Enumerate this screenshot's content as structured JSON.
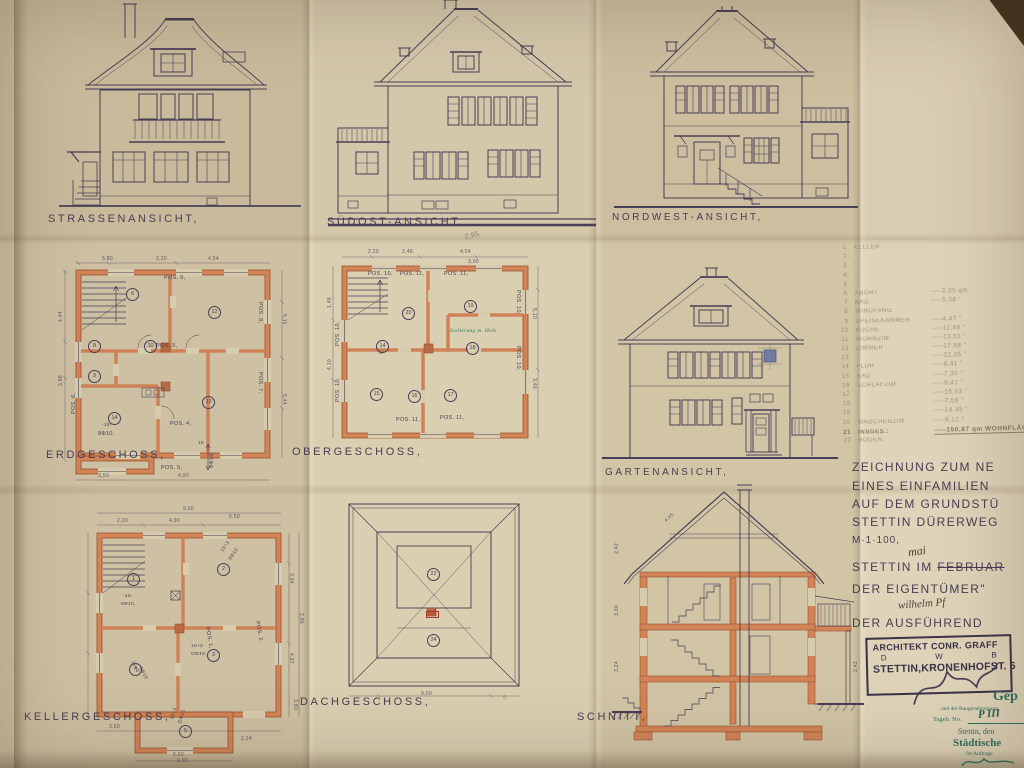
{
  "sheet": {
    "labels": {
      "strasse": "STRASSENANSICHT,",
      "suedost": "SÜDOST-ANSICHT,",
      "nordwest": "NORDWEST-ANSICHT,",
      "erdgeschoss": "ERDGESCHOSS,",
      "obergeschoss": "OBERGESCHOSS,",
      "garten": "GARTENANSICHT,",
      "keller": "KELLERGESCHOSS,",
      "dach": "DACHGESCHOSS,",
      "schnitt": "SCHNITT,"
    },
    "colors": {
      "paper": "#d8ccae",
      "ink": "#483e55",
      "wall_fill": "#d28457",
      "wall_edge": "#96502f",
      "pencil": "#8b8068",
      "stamp_green": "#2f6f5f",
      "blue_mark": "#5d6e9e"
    }
  },
  "room_list": {
    "items": [
      {
        "no": "1",
        "name": "KELLER",
        "area": ""
      },
      {
        "no": "2",
        "name": "\"",
        "area": ""
      },
      {
        "no": "3",
        "name": "\"",
        "area": ""
      },
      {
        "no": "4",
        "name": "\"",
        "area": ""
      },
      {
        "no": "5",
        "name": "\"",
        "area": ""
      },
      {
        "no": "6",
        "name": "ABORT",
        "area": "2,05 qm"
      },
      {
        "no": "7",
        "name": "BAD",
        "area": "5,08 \""
      },
      {
        "no": "8",
        "name": "WINDFANG",
        "area": ""
      },
      {
        "no": "9",
        "name": "SPEISEKAMMER",
        "area": "4,47 \""
      },
      {
        "no": "10",
        "name": "KÜCHE",
        "area": "11,88 \""
      },
      {
        "no": "11",
        "name": "WOHNZIM.",
        "area": "13,52 \""
      },
      {
        "no": "12",
        "name": "ZIMMER",
        "area": "17,58 \""
      },
      {
        "no": "13",
        "name": "\"",
        "area": "22,05 \""
      },
      {
        "no": "14",
        "name": "FLUR",
        "area": "8,41 \""
      },
      {
        "no": "15",
        "name": "BAD",
        "area": "7,30 \""
      },
      {
        "no": "16",
        "name": "SCHLAFZIM.",
        "area": "8,41 \""
      },
      {
        "no": "17",
        "name": "\"",
        "area": "15,03 \""
      },
      {
        "no": "18",
        "name": "\"",
        "area": "7,58 \""
      },
      {
        "no": "19",
        "name": "\"",
        "area": "14,45 \""
      },
      {
        "no": "20",
        "name": "MÄDCHENZIM.",
        "area": "8,12 \""
      },
      {
        "no": "21",
        "name": "INSGES.:",
        "area": "150,87 qm WOHNFLÄC",
        "cls": "total"
      },
      {
        "no": "22",
        "name": "BODEN.",
        "area": ""
      }
    ]
  },
  "title_block": {
    "line1": "ZEICHNUNG ZUM NE",
    "line2": "EINES EINFAMILIEN",
    "line3": "AUF DEM GRUNDSTÜ",
    "line4": "STETTIN DÜRERWEG",
    "scale": "M·1·100,",
    "city_prefix": "STETTIN IM",
    "month_struck": "FEBRUAR",
    "month_hand": "mai",
    "owner": "DER EIGENTÜMER\"",
    "owner_hand": "wilhelm Pf",
    "executor": "DER AUSFÜHREND"
  },
  "architect_stamp": {
    "line1": "ARCHITEKT CONR. GRAFF",
    "col1": "D",
    "col2": "W",
    "col3": "B",
    "line3": "STETTIN,KRONENHOFST. 6"
  },
  "approval_stamp": {
    "gep": "Gep",
    "line2": "und der Baugenehmigung",
    "line3": "Tageb. No.",
    "hand": "P III",
    "line4": "Stettin, den",
    "line5": "Städtische",
    "line6": "Im Auftrage"
  },
  "annotations": {
    "erdgeschoss": [
      {
        "t": "POS. 9,",
        "x": 106,
        "y": 20
      },
      {
        "t": "POS. 8,",
        "x": 204,
        "y": 46,
        "r": 90
      },
      {
        "t": "POS. 7,",
        "x": 204,
        "y": 116,
        "r": 90
      },
      {
        "t": "POS. 3,",
        "x": 98,
        "y": 88
      },
      {
        "t": "POS. 4,",
        "x": 112,
        "y": 166
      },
      {
        "t": "POS. 5,",
        "x": 103,
        "y": 210
      },
      {
        "t": "POS. 6,",
        "x": 14,
        "y": 158,
        "r": -90
      },
      {
        "t": "-15-",
        "x": 44,
        "y": 168,
        "c": "sm"
      },
      {
        "t": "8Φ10,",
        "x": 40,
        "y": 176
      },
      {
        "t": "15",
        "x": 140,
        "y": 186,
        "c": "sm"
      },
      {
        "t": "8Φ10",
        "x": 152,
        "y": 212,
        "r": -90
      },
      {
        "t": "6",
        "x": 68,
        "y": 32,
        "c": "circ"
      },
      {
        "t": "8",
        "x": 30,
        "y": 84,
        "c": "circ"
      },
      {
        "t": "9",
        "x": 30,
        "y": 114,
        "c": "circ"
      },
      {
        "t": "10",
        "x": 86,
        "y": 84,
        "c": "circ"
      },
      {
        "t": "12",
        "x": 150,
        "y": 50,
        "c": "circ"
      },
      {
        "t": "13",
        "x": 144,
        "y": 140,
        "c": "circ"
      },
      {
        "t": "14",
        "x": 50,
        "y": 156,
        "c": "circ"
      },
      {
        "t": "5,80",
        "x": 44,
        "y": 1,
        "c": "dim"
      },
      {
        "t": "2,20",
        "x": 98,
        "y": 1,
        "c": "dim"
      },
      {
        "t": "4,54",
        "x": 150,
        "y": 1,
        "c": "dim"
      },
      {
        "t": "4,44",
        "x": 1,
        "y": 66,
        "r": -90,
        "c": "dim"
      },
      {
        "t": "3,98",
        "x": 1,
        "y": 130,
        "r": -90,
        "c": "dim"
      },
      {
        "t": "5,11",
        "x": 228,
        "y": 58,
        "r": 90,
        "c": "dim"
      },
      {
        "t": "5,44",
        "x": 228,
        "y": 138,
        "r": 90,
        "c": "dim"
      },
      {
        "t": "3,50",
        "x": 40,
        "y": 218,
        "c": "dim"
      },
      {
        "t": "4,90",
        "x": 120,
        "y": 218,
        "c": "dim"
      }
    ],
    "obergeschoss": [
      {
        "t": "POS. 10,",
        "x": 40,
        "y": 22
      },
      {
        "t": "POS. 11,",
        "x": 72,
        "y": 22
      },
      {
        "t": "POS. 11,",
        "x": 116,
        "y": 22
      },
      {
        "t": "POS. 10,",
        "x": 192,
        "y": 40,
        "r": 90
      },
      {
        "t": "POS. 10,",
        "x": 192,
        "y": 96,
        "r": 90
      },
      {
        "t": "POS. 10,",
        "x": 8,
        "y": 96,
        "r": -90
      },
      {
        "t": "POS. 10,",
        "x": 8,
        "y": 152,
        "r": -90
      },
      {
        "t": "POS. 11,",
        "x": 68,
        "y": 168
      },
      {
        "t": "POS. 11,",
        "x": 112,
        "y": 166
      },
      {
        "t": "Isolierung m. Holz",
        "x": 122,
        "y": 79,
        "c": "green"
      },
      {
        "t": "12",
        "x": 50,
        "y": 101,
        "c": "green"
      },
      {
        "t": "14",
        "x": 48,
        "y": 90,
        "c": "circ"
      },
      {
        "t": "15",
        "x": 42,
        "y": 138,
        "c": "circ"
      },
      {
        "t": "16",
        "x": 80,
        "y": 140,
        "c": "circ"
      },
      {
        "t": "17",
        "x": 116,
        "y": 139,
        "c": "circ"
      },
      {
        "t": "18",
        "x": 138,
        "y": 92,
        "c": "circ"
      },
      {
        "t": "19",
        "x": 136,
        "y": 50,
        "c": "circ"
      },
      {
        "t": "20",
        "x": 74,
        "y": 57,
        "c": "circ"
      },
      {
        "t": "2,20",
        "x": 40,
        "y": 0,
        "c": "dim"
      },
      {
        "t": "2,48",
        "x": 74,
        "y": 0,
        "c": "dim"
      },
      {
        "t": "4,54",
        "x": 132,
        "y": 0,
        "c": "dim"
      },
      {
        "t": "3,00",
        "x": 140,
        "y": 10,
        "c": "dim"
      },
      {
        "t": "5,10",
        "x": 208,
        "y": 58,
        "r": 90,
        "c": "dim"
      },
      {
        "t": "3,48",
        "x": 208,
        "y": 128,
        "r": 90,
        "c": "dim"
      },
      {
        "t": "1,48",
        "x": 0,
        "y": 58,
        "r": -90,
        "c": "dim"
      },
      {
        "t": "4,10",
        "x": 0,
        "y": 120,
        "r": -90,
        "c": "dim"
      }
    ],
    "keller": [
      {
        "t": "1",
        "x": 44,
        "y": 70,
        "c": "circ"
      },
      {
        "t": "2",
        "x": 134,
        "y": 60,
        "c": "circ"
      },
      {
        "t": "3",
        "x": 124,
        "y": 146,
        "c": "circ"
      },
      {
        "t": "4",
        "x": 46,
        "y": 160,
        "c": "circ"
      },
      {
        "t": "5",
        "x": 96,
        "y": 222,
        "c": "circ"
      },
      {
        "t": "15+3",
        "x": 138,
        "y": 48,
        "r": -55,
        "c": "sm"
      },
      {
        "t": "8Φ10",
        "x": 146,
        "y": 56,
        "r": -55,
        "c": "sm"
      },
      {
        "t": "-15-",
        "x": 40,
        "y": 92,
        "c": "sm"
      },
      {
        "t": "8Φ10,",
        "x": 38,
        "y": 100,
        "c": "sm"
      },
      {
        "t": "15+3",
        "x": 50,
        "y": 158,
        "r": 62,
        "c": "sm"
      },
      {
        "t": "8Φ10",
        "x": 58,
        "y": 164,
        "r": 62,
        "c": "sm"
      },
      {
        "t": "10+3",
        "x": 108,
        "y": 142,
        "c": "sm"
      },
      {
        "t": "ΟΦ10",
        "x": 108,
        "y": 150,
        "c": "sm"
      },
      {
        "t": "10+3",
        "x": 88,
        "y": 216,
        "r": -72,
        "c": "sm"
      },
      {
        "t": "ΟΦ10",
        "x": 96,
        "y": 220,
        "r": -72,
        "c": "sm"
      },
      {
        "t": "POS. 1,",
        "x": 126,
        "y": 124,
        "r": 80
      },
      {
        "t": "POS. 2,",
        "x": 176,
        "y": 118,
        "r": 80
      },
      {
        "t": "2,20",
        "x": 34,
        "y": 16,
        "c": "dim"
      },
      {
        "t": "4,90",
        "x": 86,
        "y": 16,
        "c": "dim"
      },
      {
        "t": "5,50",
        "x": 146,
        "y": 12,
        "c": "dim"
      },
      {
        "t": "9,00",
        "x": 100,
        "y": 4,
        "c": "dim"
      },
      {
        "t": "3,94",
        "x": 210,
        "y": 70,
        "r": 90,
        "c": "dim"
      },
      {
        "t": "2,86",
        "x": 220,
        "y": 110,
        "r": 90,
        "c": "dim"
      },
      {
        "t": "4,97",
        "x": 210,
        "y": 150,
        "r": 90,
        "c": "dim"
      },
      {
        "t": "3,80",
        "x": 214,
        "y": 196,
        "r": 90,
        "c": "dim"
      },
      {
        "t": "3,50",
        "x": 26,
        "y": 222,
        "c": "dim"
      },
      {
        "t": "5,50",
        "x": 90,
        "y": 250,
        "c": "dim"
      },
      {
        "t": "2,24",
        "x": 158,
        "y": 234,
        "c": "dim"
      },
      {
        "t": "9,00",
        "x": 94,
        "y": 256,
        "c": "dim"
      }
    ],
    "dach": [
      {
        "t": "22",
        "x": 94,
        "y": 80,
        "c": "circ"
      },
      {
        "t": "24",
        "x": 94,
        "y": 146,
        "c": "circ"
      },
      {
        "t": "5,8",
        "x": 93,
        "y": 123,
        "c": "red"
      },
      {
        "t": "9,00",
        "x": 88,
        "y": 204,
        "c": "dim"
      },
      {
        "t": "6",
        "x": 170,
        "y": 208,
        "c": "pencil"
      }
    ],
    "schnitt": [
      {
        "t": "2,42",
        "x": 3,
        "y": 78,
        "r": -90,
        "c": "dim"
      },
      {
        "t": "3,00",
        "x": 3,
        "y": 140,
        "r": -90,
        "c": "dim"
      },
      {
        "t": "3,24",
        "x": 3,
        "y": 196,
        "r": -90,
        "c": "dim"
      },
      {
        "t": "2,42",
        "x": 242,
        "y": 196,
        "r": -90,
        "c": "dim"
      },
      {
        "t": "4,45",
        "x": 52,
        "y": 44,
        "r": -42,
        "c": "dim"
      }
    ],
    "stray": [
      {
        "t": "2,95",
        "x": 464,
        "y": 234,
        "c": "pencil",
        "s": 7,
        "r": -12
      }
    ]
  }
}
